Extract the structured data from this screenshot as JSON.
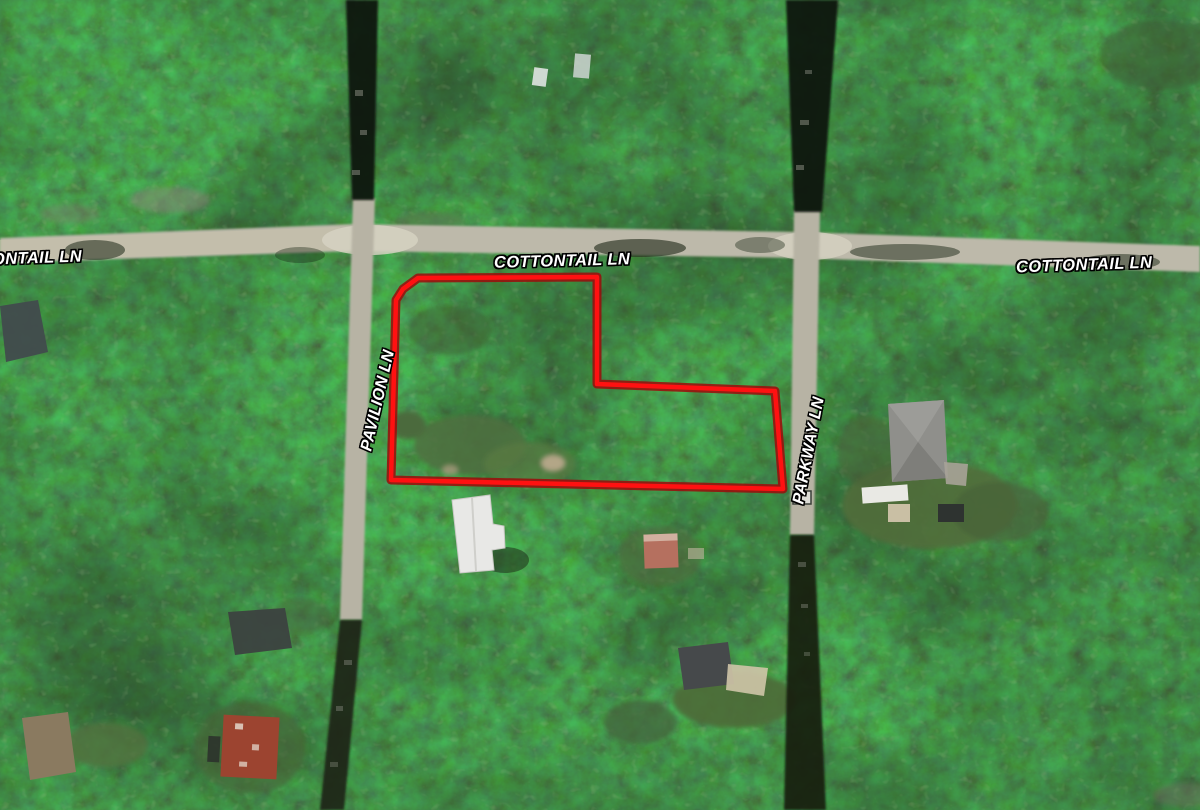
{
  "map": {
    "description": "Aerial satellite imagery of wooded residential area with highlighted parcel",
    "labels": {
      "cottontail_left_partial": "ONTAIL LN",
      "cottontail_center": "COTTONTAIL LN",
      "cottontail_right": "COTTONTAIL LN",
      "pavilion": "PAVILION LN",
      "parkway": "PARKWAY LN"
    },
    "colors": {
      "parcel_outline": "#ff1111",
      "parcel_outline_edge": "#9c0a0a",
      "road_pavement": "#bdb9aa",
      "forest_base": "#2e3d26",
      "label_text": "#ffffff"
    }
  },
  "parcel": {
    "outline_points": "418,278 597,277 597,384 775,391 783,489 391,480 396,300 403,289"
  }
}
